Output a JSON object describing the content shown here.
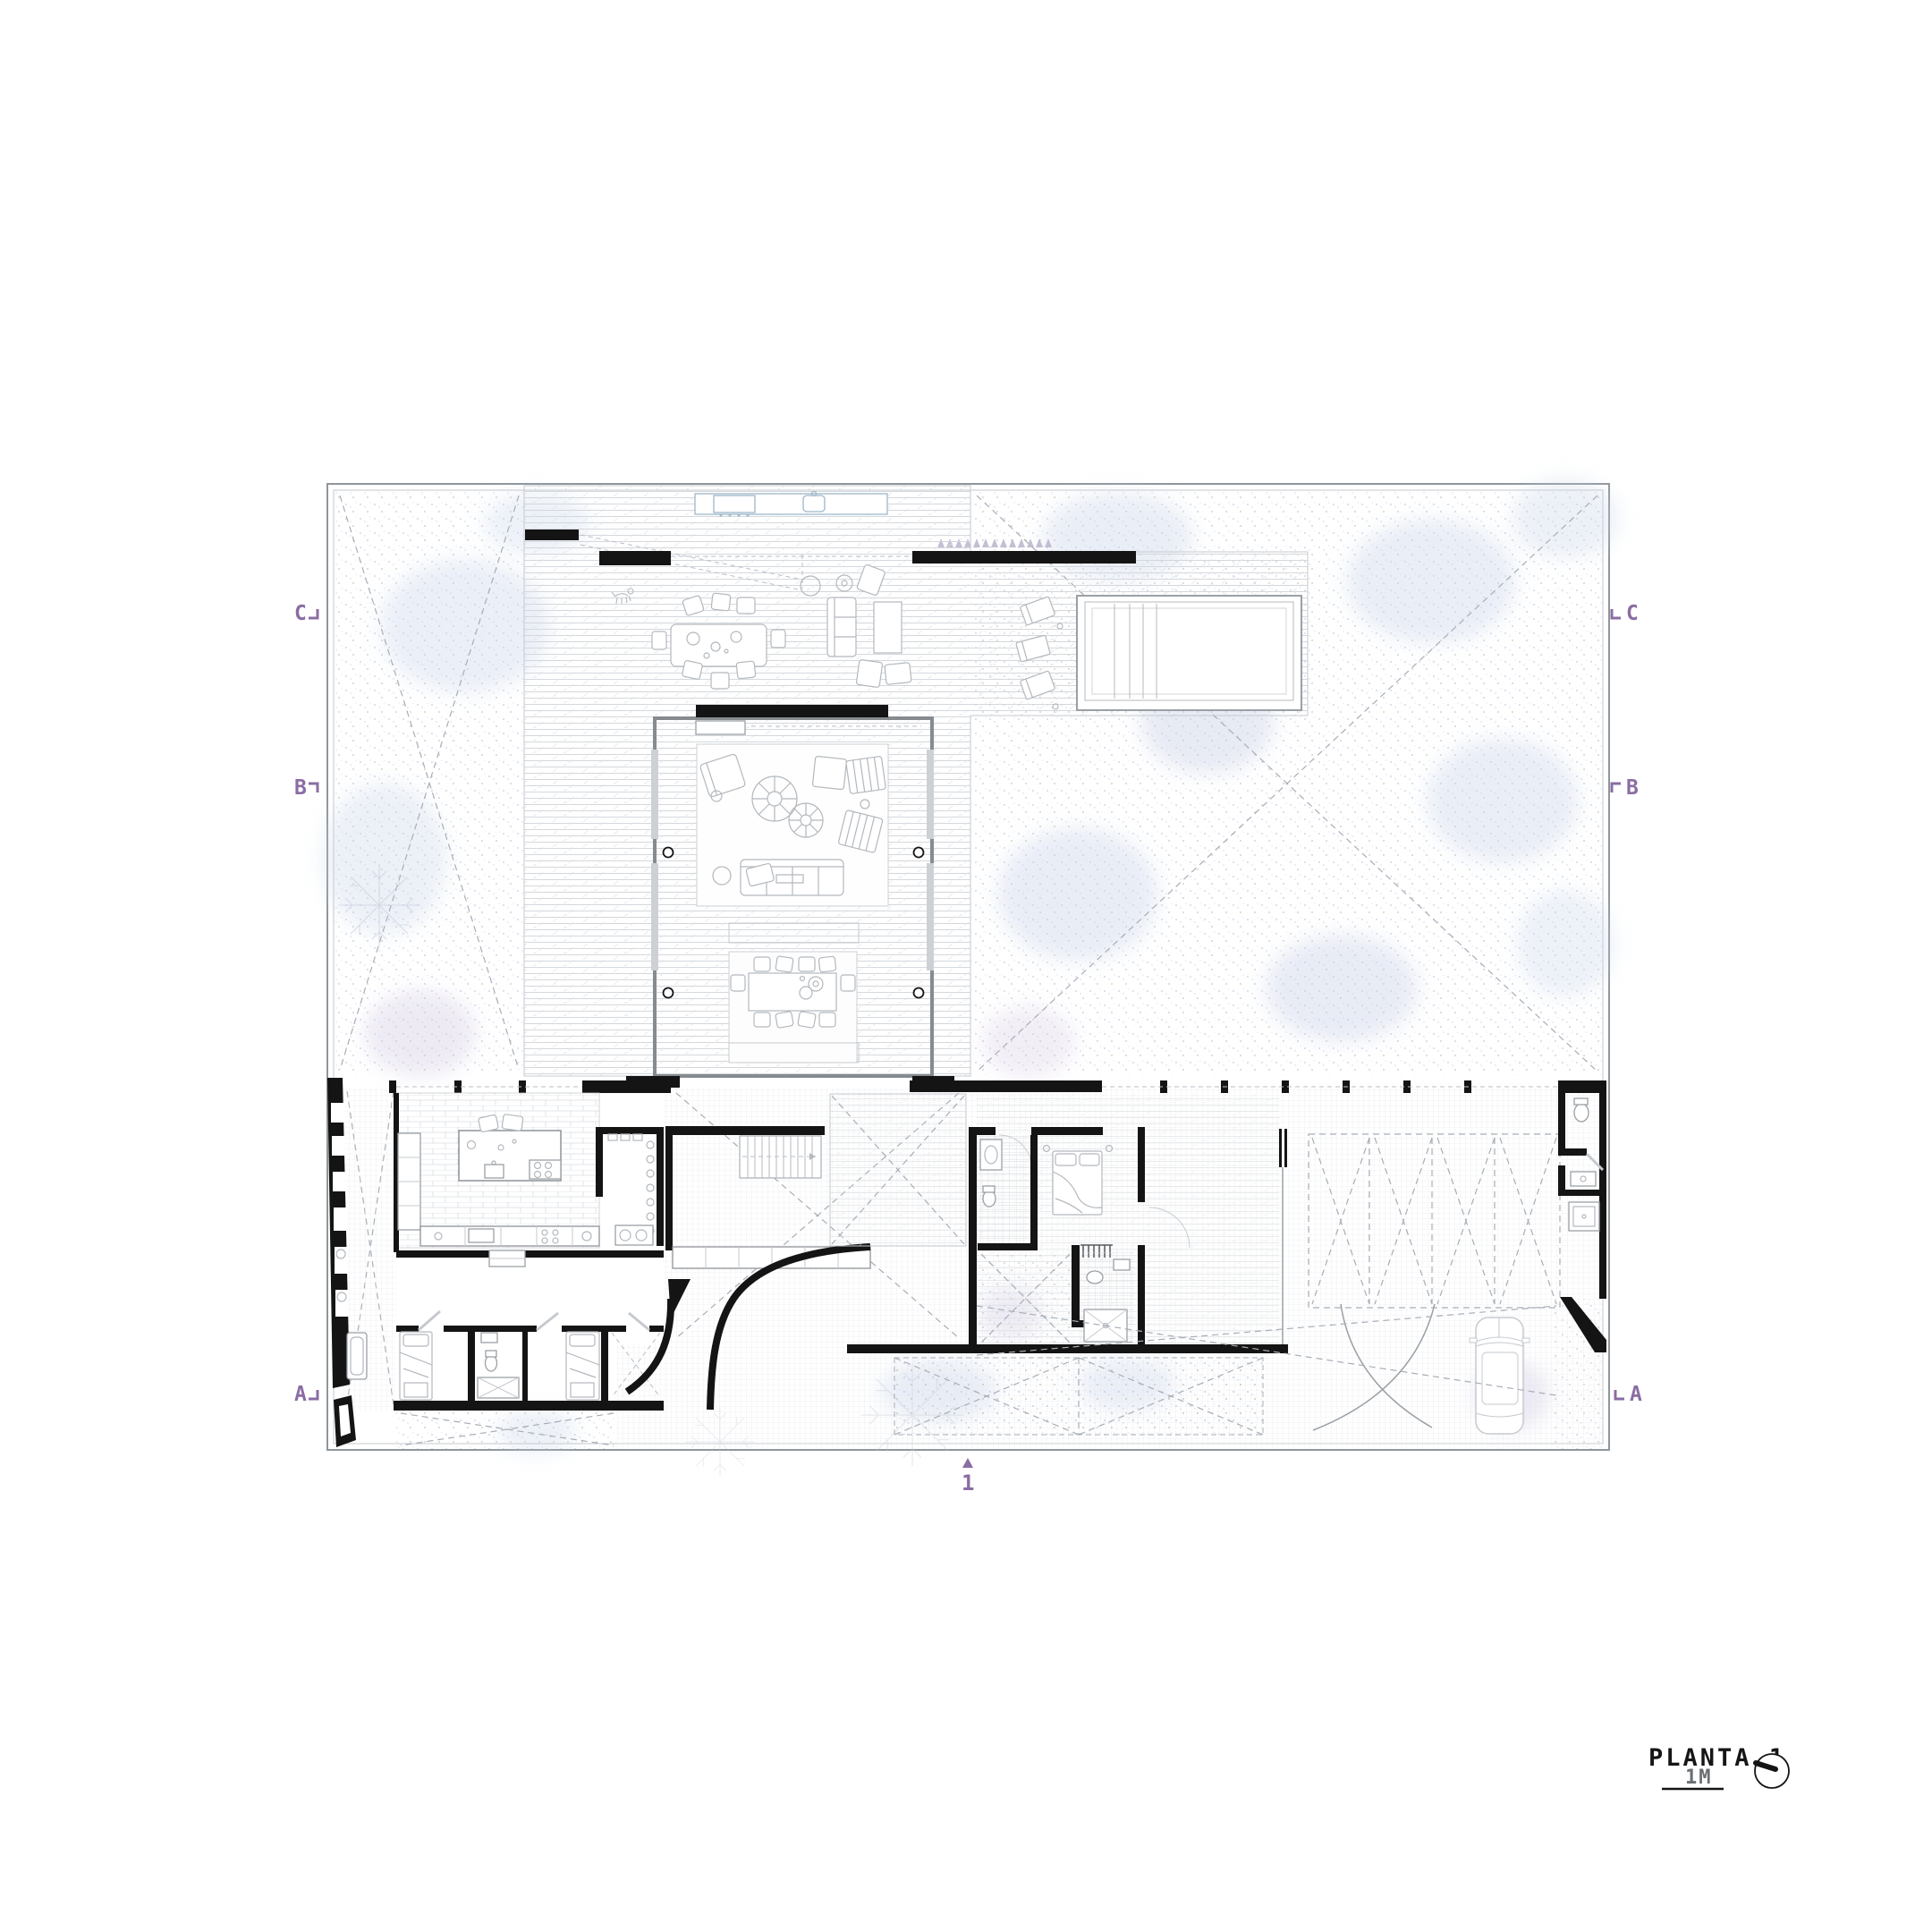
{
  "annotations": {
    "floor_label": "PLANTA 1",
    "scale_label": "1M",
    "entry_marker": "1",
    "sections_left": [
      "C",
      "B",
      "A"
    ],
    "sections_right": [
      "C",
      "B",
      "A"
    ]
  },
  "colors": {
    "accent_purple": "#8a6da3",
    "wall_black": "#141414",
    "site_border_gray": "#8f959b",
    "furniture_gray": "#b3b8bd",
    "water_blue": "#9fb7c9",
    "garden_blue": "#ccd7ea",
    "paper_white": "#ffffff"
  }
}
